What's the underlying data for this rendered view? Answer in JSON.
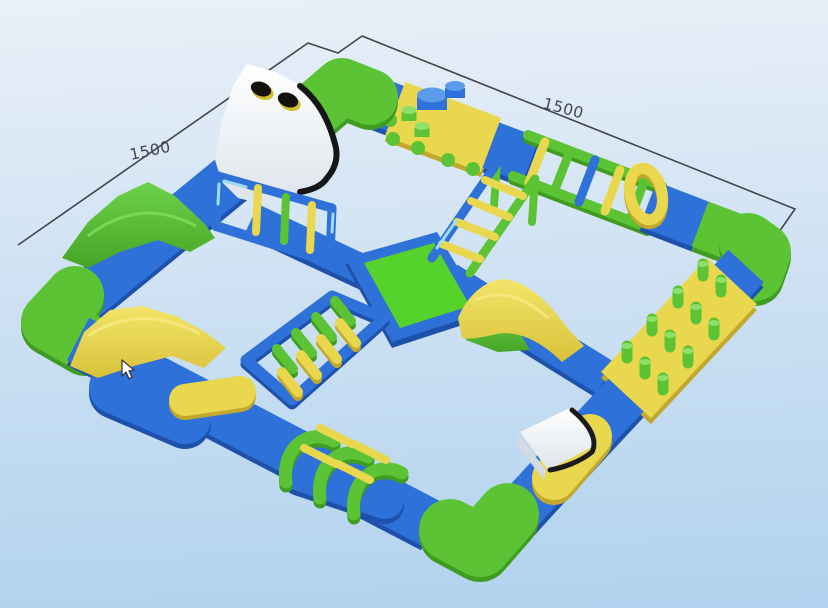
{
  "scene": {
    "title": "3D render of an inflatable floating water park obstacle course",
    "dimension_labels": {
      "left": "1500",
      "right": "1500"
    },
    "colors": {
      "bg-top": "#e9f0f8",
      "bg-mid": "#cfe2f3",
      "bg-bottom": "#b0d2ee",
      "blue": "#2e71d8",
      "blue-dark": "#1e51ab",
      "blue-light": "#5a9bea",
      "cyan": "#9fdcf2",
      "green": "#5cc335",
      "green-dark": "#3f9c20",
      "green-bright": "#55d22c",
      "green-light": "#8ce06b",
      "yellow": "#e9d74d",
      "yellow-dark": "#c2a82c",
      "white": "#fdfdfd",
      "outline": "#161616",
      "dim": "#43444c"
    },
    "obstacles": [
      "perimeter-walkway",
      "white-climbing-wall",
      "hurdle-frame-bridge",
      "cylinder-platform",
      "rope-ladder-bridge",
      "angled-ladder",
      "yellow-arch-ring",
      "green-peg-platform",
      "wave-slide",
      "center-platform",
      "floating-log-bridge",
      "green-wedge",
      "double-hump-slide",
      "green-arch-tunnel",
      "white-wedge-slide"
    ]
  }
}
